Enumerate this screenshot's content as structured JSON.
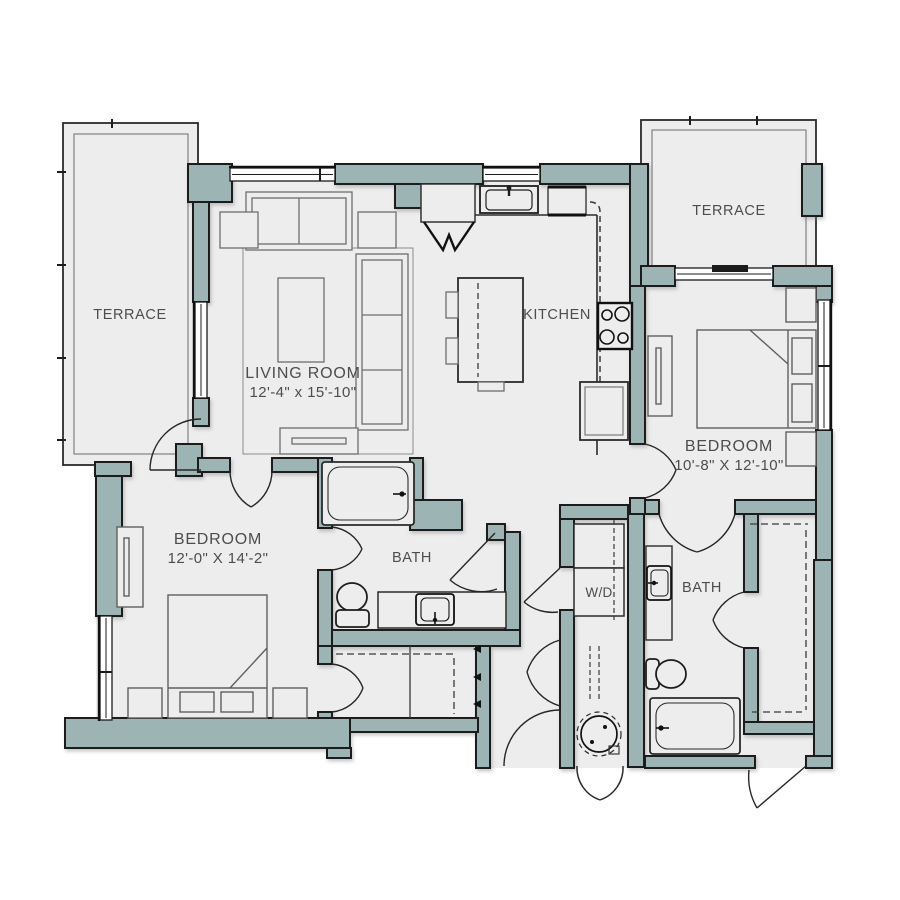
{
  "plan_title": "Two bedroom two bath floor plan",
  "colors": {
    "wall": "#9cb4b3",
    "floor": "#ededee",
    "outline": "#1d1d1d",
    "furniture": "#6e6e6e",
    "label_text": "#4d4d4d"
  },
  "rooms": {
    "terrace_left": {
      "label": "TERRACE"
    },
    "terrace_right": {
      "label": "TERRACE"
    },
    "living": {
      "label": "LIVING ROOM",
      "dims": "12'-4\" x 15'-10\""
    },
    "kitchen": {
      "label": "KITCHEN"
    },
    "bedroom_left": {
      "label": "BEDROOM",
      "dims": "12'-0\" X 14'-2\""
    },
    "bedroom_right": {
      "label": "BEDROOM",
      "dims": "10'-8\" X 12'-10\""
    },
    "bath_main": {
      "label": "BATH"
    },
    "bath_second": {
      "label": "BATH"
    },
    "laundry": {
      "label": "W/D"
    }
  }
}
